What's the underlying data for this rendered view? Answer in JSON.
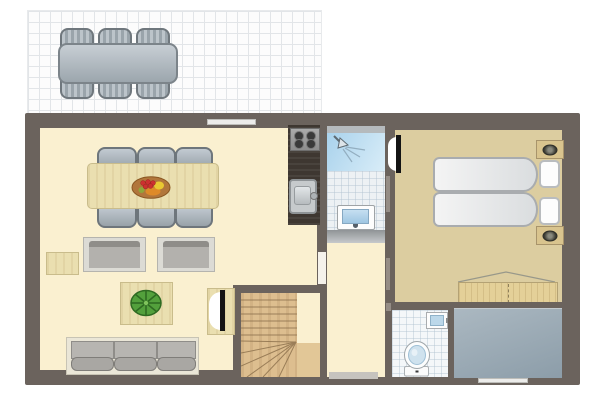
{
  "meta": {
    "type": "floor-plan",
    "description": "single floor holiday-home plan, top-down view, no text labels"
  },
  "colors": {
    "wall": "#6B635D",
    "floor": "#FAF0D0",
    "bedroomFloor": "#DCCDA0",
    "tile": "#EDF1F4",
    "showerA": "#A9D2EC",
    "showerB": "#D9EDF8",
    "stairsWood": "#DDBE8F",
    "furnitureWood": "#EADFB0",
    "counter": "#3E3731",
    "storageA": "#ABB8C1",
    "storageB": "#8C9DA9",
    "chairGray": "#A9B2BA",
    "windowStrip": "#ECECEA",
    "terraceLine": "#E2E5E8"
  },
  "areas": [
    {
      "id": "terrace",
      "floor": "white-grid-tiles",
      "furniture": [
        {
          "id": "outdoor-dining-table",
          "count": 1
        },
        {
          "id": "outdoor-chair",
          "count": 6
        }
      ]
    },
    {
      "id": "living-room",
      "floor": "cream",
      "furniture": [
        {
          "id": "dining-table",
          "count": 1
        },
        {
          "id": "dining-chair",
          "count": 6
        },
        {
          "id": "fruit-bowl",
          "count": 1
        },
        {
          "id": "armchair",
          "count": 2
        },
        {
          "id": "side-table",
          "count": 1
        },
        {
          "id": "coffee-table",
          "count": 1
        },
        {
          "id": "potted-plant",
          "count": 1
        },
        {
          "id": "sofa",
          "seat-cushions": 3
        },
        {
          "id": "interior-door-with-swing",
          "count": 1
        }
      ]
    },
    {
      "id": "kitchen",
      "floor": "cream",
      "furniture": [
        {
          "id": "stove",
          "burners": 4
        },
        {
          "id": "kitchen-sink",
          "count": 1
        }
      ]
    },
    {
      "id": "bathroom",
      "floor": "white-tiles",
      "furniture": [
        {
          "id": "shower",
          "count": 1
        },
        {
          "id": "washbasin",
          "count": 1
        },
        {
          "id": "threshold",
          "count": 1
        }
      ]
    },
    {
      "id": "hallway",
      "floor": "cream",
      "furniture": []
    },
    {
      "id": "staircase",
      "floor": "wood",
      "furniture": [
        {
          "id": "winder-stairs",
          "straight-treads": 6
        }
      ]
    },
    {
      "id": "bedroom",
      "floor": "tan",
      "furniture": [
        {
          "id": "double-bed",
          "mattresses": 2,
          "pillows": 2
        },
        {
          "id": "nightstand-with-lamp",
          "count": 2
        },
        {
          "id": "wardrobe",
          "count": 1
        },
        {
          "id": "door-with-swing",
          "count": 1
        }
      ]
    },
    {
      "id": "toilet-room",
      "floor": "white-tiles",
      "furniture": [
        {
          "id": "toilet",
          "count": 1
        },
        {
          "id": "wall-sink",
          "count": 1
        }
      ]
    },
    {
      "id": "storage-room",
      "floor": "blue-gray",
      "furniture": []
    }
  ],
  "openings": {
    "windows": [
      {
        "id": "living-room-top-window"
      },
      {
        "id": "storage-room-bottom-window"
      }
    ],
    "doors": [
      {
        "id": "bedroom-door"
      },
      {
        "id": "stairs-door"
      },
      {
        "id": "hallway-opening"
      },
      {
        "id": "entry-strip"
      }
    ]
  }
}
